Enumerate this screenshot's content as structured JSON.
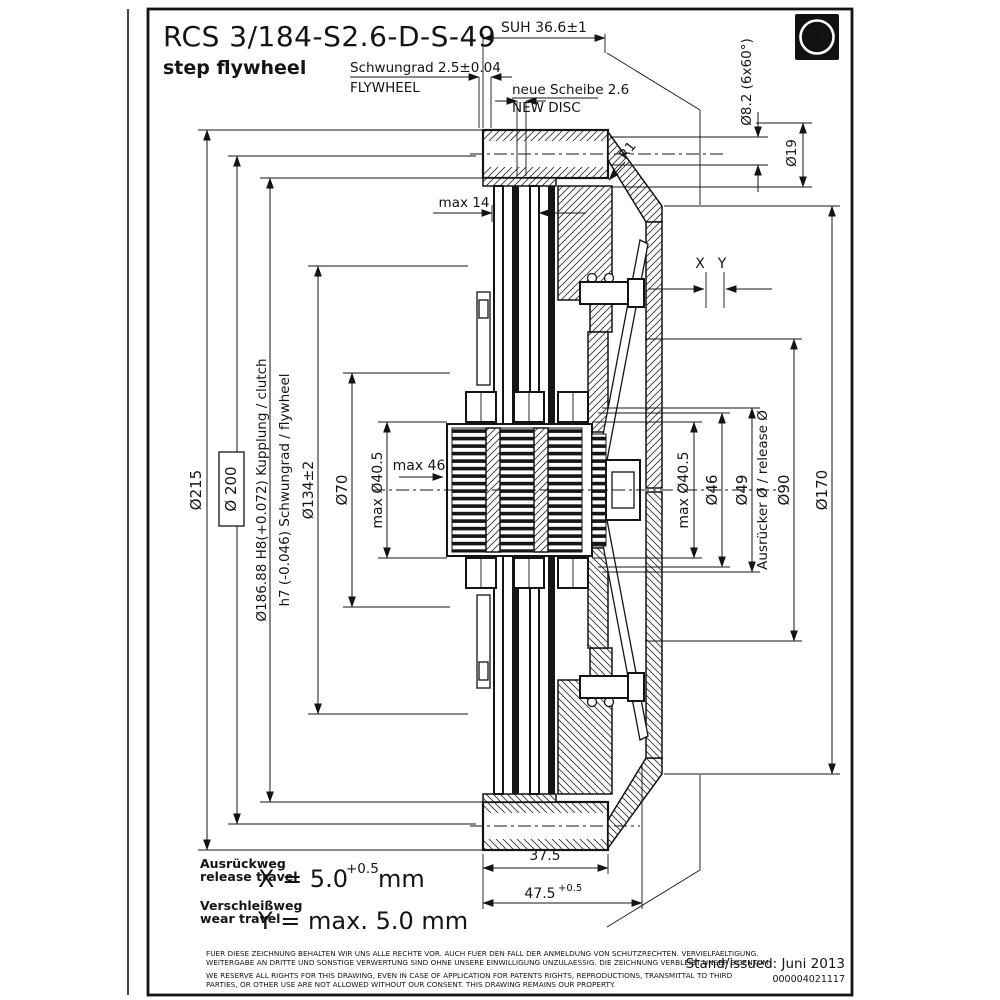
{
  "drawing": {
    "title": "RCS 3/184-S2.6-D-S-49",
    "subtitle": "step flywheel",
    "logo_text": "ZF",
    "issued": "Stand/issued: Juni 2013",
    "doc_number": "000004021117"
  },
  "annotations": {
    "suh": "SUH 36.6±1",
    "flywheel_de": "Schwungrad 2.5±0.04",
    "flywheel_en": "FLYWHEEL",
    "disc_de": "neue Scheibe 2.6",
    "disc_en": "NEW DISC",
    "holes": "Ø8.2 (6x60°)",
    "d19": "Ø19",
    "r1": "R1",
    "max14": "max 14",
    "x": "X",
    "y": "Y",
    "max46": "max 46"
  },
  "diameters_left": {
    "d215": "Ø215",
    "d200": "Ø 200",
    "d186": "Ø186.88 H8(+0.072)  Kupplung / clutch",
    "h7": "h7 (-0.046)  Schwungrad / flywheel",
    "d134": "Ø134±2",
    "d70": "Ø70",
    "max_d405": "max Ø40.5"
  },
  "diameters_right": {
    "max_d405": "max Ø40.5",
    "d46": "Ø46",
    "d49": "Ø49",
    "release": "Ausrücker Ø  /  release Ø",
    "d90": "Ø90",
    "d170": "Ø170"
  },
  "dims_bottom": {
    "w375": "37.5",
    "w475": "47.5",
    "w475_tol": "+0.5"
  },
  "travel": {
    "release_de": "Ausrückweg",
    "release_en": "release travel",
    "x_value": "X = 5.0",
    "x_tol": "+0.5",
    "x_unit": "mm",
    "wear_de": "Verschleißweg",
    "wear_en": "wear travel",
    "y_value": "Y = max. 5.0 mm"
  },
  "legal": {
    "de1": "FUER DIESE ZEICHNUNG BEHALTEN WIR UNS ALLE RECHTE VOR. AUCH FUER DEN FALL DER ANMELDUNG VON SCHUTZRECHTEN. VERVIELFAELTIGUNG.",
    "de2": "WEITERGABE AN DRITTE UND SONSTIGE VERWERTUNG SIND OHNE UNSERE EINWILLIGUNG UNZULAESSIG. DIE ZEICHNUNG VERBLEIBT UNSER EIGENTUM.",
    "en1": "WE RESERVE ALL RIGHTS FOR THIS DRAWING, EVEN IN CASE OF APPLICATION FOR PATENTS RIGHTS, REPRODUCTIONS, TRANSMITTAL TO THIRD",
    "en2": "PARTIES, OR OTHER USE ARE NOT ALLOWED WITHOUT OUR CONSENT. THIS DRAWING REMAINS OUR PROPERTY."
  }
}
